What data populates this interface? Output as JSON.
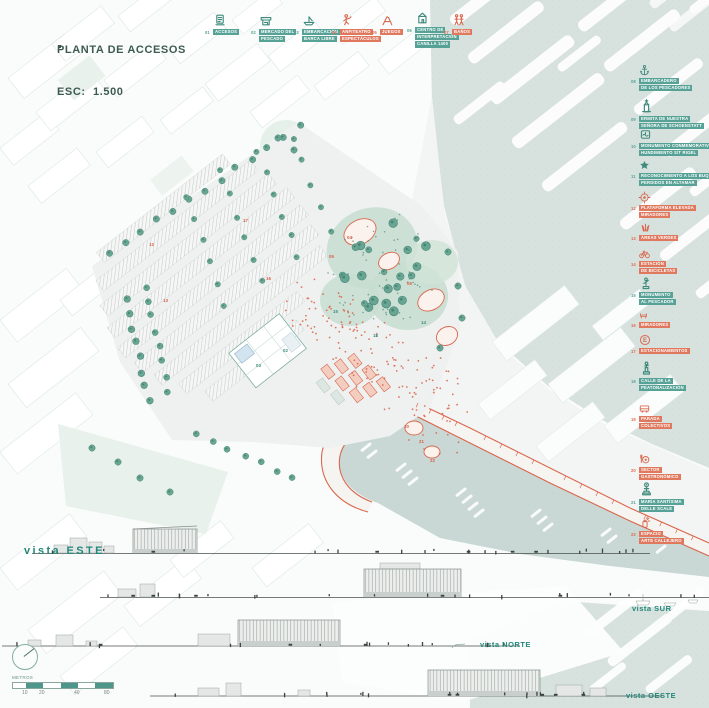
{
  "title": {
    "line1": "PLANTA DE ACCESOS",
    "line2": "ESC:  1.500"
  },
  "colors": {
    "teal": "#57a296",
    "teal_icon": "#3f8a7c",
    "red": "#dd6a50",
    "water": "#d7e2df",
    "harbor": "#c9d8d4",
    "ink": "#3c5a52",
    "vista": "#23877a"
  },
  "legend_top": {
    "items": [
      {
        "num": "01",
        "lines": [
          "ACCESOS"
        ],
        "color": "teal",
        "icon": "ticket-office"
      },
      {
        "num": "02",
        "lines": [
          "MERCADO DEL",
          "PESCADO"
        ],
        "color": "teal",
        "icon": "fish-market"
      },
      {
        "num": "03",
        "lines": [
          "EMBARCACIÓN",
          "BARCA LIBRE"
        ],
        "color": "teal",
        "icon": "boat"
      },
      {
        "num": "04",
        "lines": [
          "ANFITEATRO",
          "ESPECTÁCULOS"
        ],
        "color": "red",
        "icon": "performer"
      },
      {
        "num": "05",
        "lines": [
          "JUEGOS"
        ],
        "color": "red",
        "icon": "playground"
      },
      {
        "num": "06",
        "lines": [
          "CENTRO DE",
          "INTERPRETACIÓN",
          "CANILLA 1400"
        ],
        "color": "teal",
        "icon": "interpretation-center"
      },
      {
        "num": "07",
        "lines": [
          "BAÑOS"
        ],
        "color": "red",
        "icon": "restrooms"
      }
    ]
  },
  "legend_right": {
    "items": [
      {
        "num": "08",
        "lines": [
          "EMBARCADERO",
          "DE LOS PESCADORES"
        ],
        "color": "teal",
        "icon": "anchor"
      },
      {
        "num": "09",
        "lines": [
          "ERMITA DE NUESTRA",
          "SEÑORA DE SCHOENSTATT"
        ],
        "color": "teal",
        "icon": "hermitage"
      },
      {
        "num": "10",
        "lines": [
          "MONUMENTO CONMEMORATIVO",
          "HUNDIMIENTO S/T RIGEL"
        ],
        "color": "teal",
        "icon": "memorial-plaque"
      },
      {
        "num": "11",
        "lines": [
          "RECONOCIMIENTO A LOS BUQUES",
          "PERDIDOS EN ALTAMAR"
        ],
        "color": "teal",
        "icon": "star"
      },
      {
        "num": "12",
        "lines": [
          "PLATAFORMA ELEVADA",
          "MIRADORES"
        ],
        "color": "red",
        "icon": "elevated-platform"
      },
      {
        "num": "13",
        "lines": [
          "ÁREAS VERDES"
        ],
        "color": "red",
        "icon": "grass"
      },
      {
        "num": "14",
        "lines": [
          "ESTACIÓN",
          "DE BICICLETAS"
        ],
        "color": "red",
        "icon": "bicycle"
      },
      {
        "num": "15",
        "lines": [
          "MONUMENTO",
          "AL PESCADOR"
        ],
        "color": "teal",
        "icon": "fisherman-statue"
      },
      {
        "num": "16",
        "lines": [
          "MIRADORES"
        ],
        "color": "red",
        "icon": "bench"
      },
      {
        "num": "17",
        "lines": [
          "ESTACIONAMIENTOS"
        ],
        "color": "red",
        "icon": "parking"
      },
      {
        "num": "18",
        "lines": [
          "CALLE DE LA",
          "PEATONALIZACIÓN"
        ],
        "color": "teal",
        "icon": "statue-column"
      },
      {
        "num": "19",
        "lines": [
          "PARADA",
          "COLECTIVOS"
        ],
        "color": "red",
        "icon": "bus"
      },
      {
        "num": "20",
        "lines": [
          "SECTOR",
          "GASTRONÓMICO"
        ],
        "color": "red",
        "icon": "gastronomy"
      },
      {
        "num": "21",
        "lines": [
          "MARÍA SANTÍSIMA",
          "DELLE SCALE"
        ],
        "color": "teal",
        "icon": "saint-statue"
      },
      {
        "num": "22",
        "lines": [
          "ESPACIO",
          "ARTE CALLEJERO"
        ],
        "color": "red",
        "icon": "street-art"
      }
    ]
  },
  "vistas": {
    "este": "vista ESTE",
    "sur": "vista SUR",
    "norte": "vista NORTE",
    "oeste": "vista OESTE"
  },
  "scalebar": {
    "unit_label": "METROS",
    "ticks": [
      "10",
      "20",
      "40",
      "80"
    ]
  },
  "plan_markers": [
    {
      "n": "17",
      "x": 243,
      "y": 219,
      "c": "red"
    },
    {
      "n": "12",
      "x": 149,
      "y": 243,
      "c": "red"
    },
    {
      "n": "13",
      "x": 163,
      "y": 299,
      "c": "red"
    },
    {
      "n": "04",
      "x": 347,
      "y": 236,
      "c": "red"
    },
    {
      "n": "05",
      "x": 329,
      "y": 255,
      "c": "red"
    },
    {
      "n": "06",
      "x": 407,
      "y": 282,
      "c": "red"
    },
    {
      "n": "16",
      "x": 266,
      "y": 277,
      "c": "red"
    },
    {
      "n": "18",
      "x": 373,
      "y": 334,
      "c": "teal"
    },
    {
      "n": "14",
      "x": 421,
      "y": 321,
      "c": "teal"
    },
    {
      "n": "15",
      "x": 333,
      "y": 310,
      "c": "teal"
    },
    {
      "n": "02",
      "x": 283,
      "y": 349,
      "c": "teal"
    },
    {
      "n": "03",
      "x": 256,
      "y": 364,
      "c": "teal"
    },
    {
      "n": "20",
      "x": 404,
      "y": 425,
      "c": "red"
    },
    {
      "n": "21",
      "x": 419,
      "y": 440,
      "c": "red"
    },
    {
      "n": "22",
      "x": 430,
      "y": 459,
      "c": "red"
    }
  ]
}
